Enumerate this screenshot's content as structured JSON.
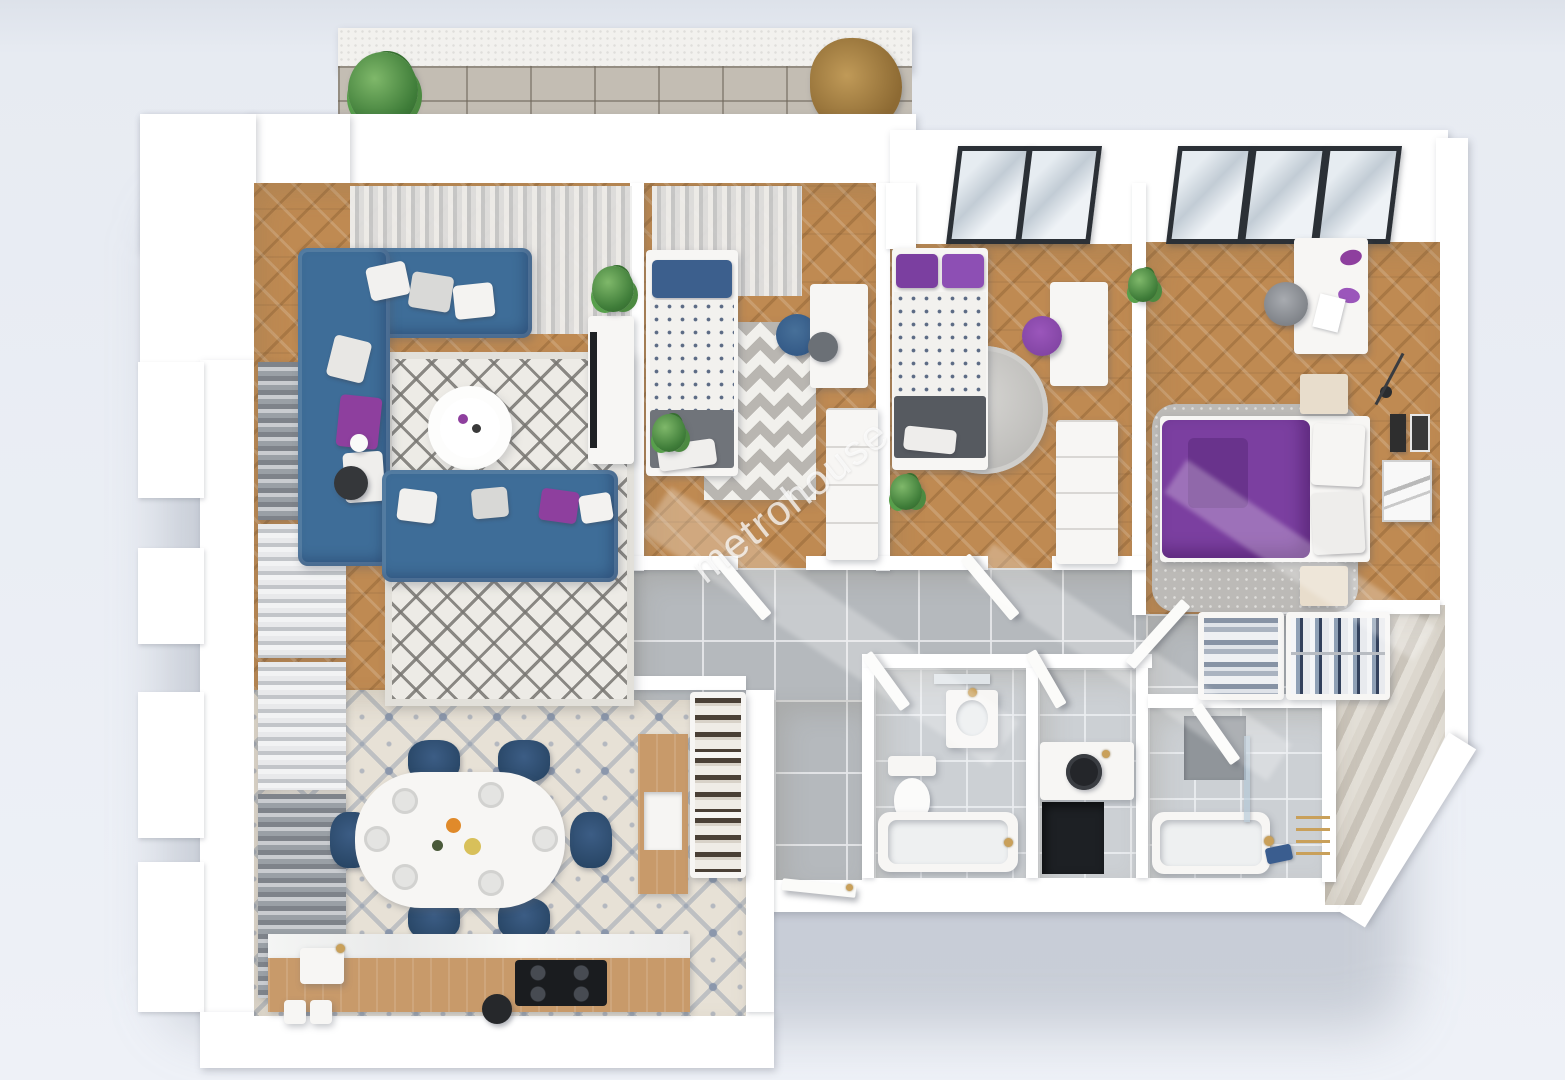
{
  "watermark": {
    "text": "metrohouse"
  },
  "scene": {
    "type": "3d-floor-plan-top-view",
    "rooms": [
      {
        "name": "balcony"
      },
      {
        "name": "living-room"
      },
      {
        "name": "dining-kitchen"
      },
      {
        "name": "bedroom-1"
      },
      {
        "name": "bedroom-2"
      },
      {
        "name": "master-bedroom"
      },
      {
        "name": "hallway"
      },
      {
        "name": "bathroom-small"
      },
      {
        "name": "wc"
      },
      {
        "name": "bathroom-main"
      },
      {
        "name": "entry-hall"
      }
    ]
  },
  "colors": {
    "background": "#e9edf4",
    "wall": "#ffffff",
    "wood_floor": "#bf8a52",
    "tile_base": "#e7e1d6",
    "tile_ornament": "#8b97ac",
    "corridor_tile": "#b5b9bd",
    "bath_tile": "#ccd0d4",
    "balcony_tile": "#c3bdb3",
    "sofa_blue": "#3e6d98",
    "accent_purple": "#8e3f9e",
    "duvet_purple": "#7b3fa0",
    "rug_grey": "#bcbab7",
    "plant_green": "#3f7d39",
    "counter_wood": "#c89a6a",
    "fixture_gold": "#c9a05a",
    "frame_dark": "#2b3036",
    "watermark": "rgba(255,255,255,0.72)"
  }
}
